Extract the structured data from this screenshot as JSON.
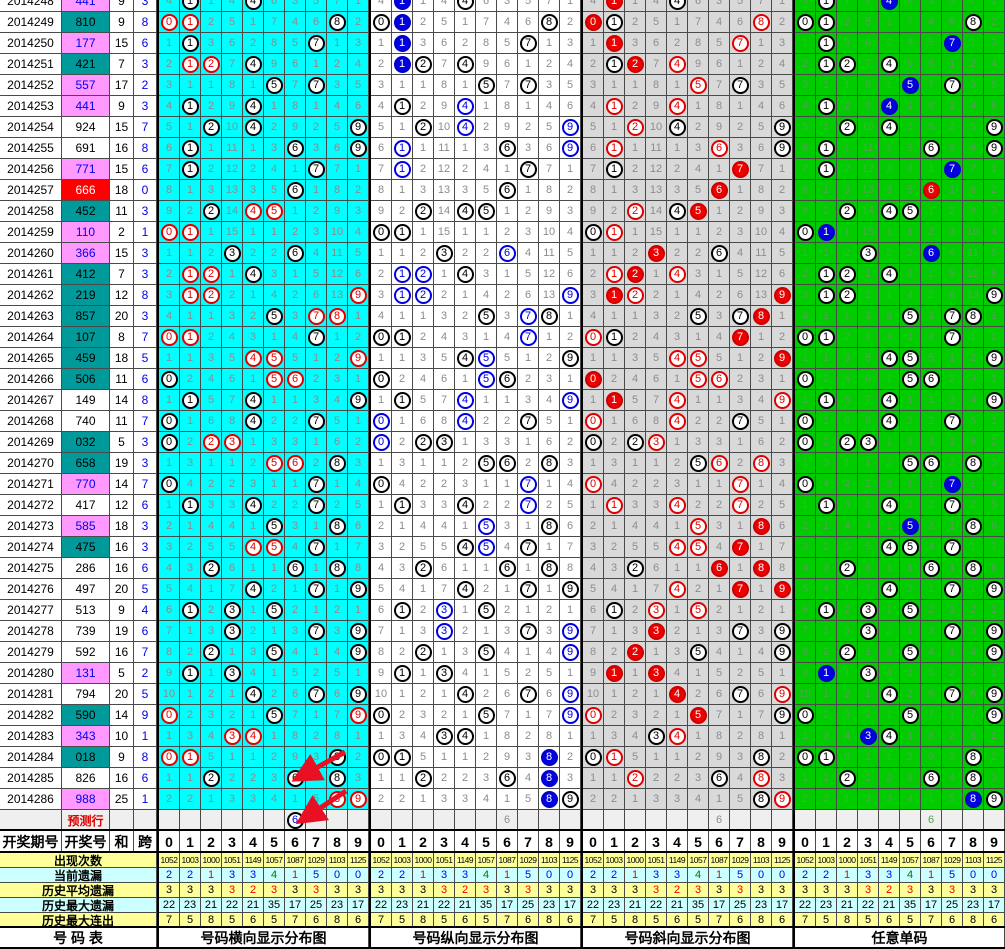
{
  "left_table": {
    "headers": {
      "period": "开奖期号",
      "number": "开奖号",
      "sum": "和",
      "span": "跨"
    },
    "footer_label": "号  码  表"
  },
  "panels": [
    {
      "key": "horizontal",
      "footer_label": "号码横向显示分布图",
      "bg": "#00FFFF"
    },
    {
      "key": "vertical",
      "footer_label": "号码纵向显示分布图",
      "bg": "#FFFFFF"
    },
    {
      "key": "diagonal",
      "footer_label": "号码斜向显示分布图",
      "bg": "#D9D9D9"
    },
    {
      "key": "single",
      "footer_label": "任意单码",
      "bg": "#00CC00"
    }
  ],
  "style_legend": {
    "k": "black-outline circle",
    "r": "red-outline circle",
    "R": "red-filled circle",
    "b": "blue-outline circle",
    "B": "blue-filled circle",
    "p": "black-outline blue-text circle"
  },
  "colors": {
    "b": "#0000EE",
    "r": "#EE0000",
    "g": "#007700",
    "k": "#000000",
    "arrow": "#E81123"
  },
  "chart_data": {
    "type": "table",
    "digit_columns": [
      "0",
      "1",
      "2",
      "3",
      "4",
      "5",
      "6",
      "7",
      "8",
      "9"
    ],
    "prediction_row_label": "预测行",
    "rows": [
      {
        "period": "2014248",
        "number": "441",
        "number_bg": "pink",
        "sum": "9",
        "span": "3",
        "clipped": true,
        "cells": [
          4,
          1,
          1,
          4,
          4,
          6,
          3,
          5,
          7,
          1
        ],
        "marks": [
          "1k,4k",
          "1B,4k",
          "1R,4k",
          "1k,4B"
        ]
      },
      {
        "period": "2014249",
        "number": "810",
        "number_bg": "teal",
        "sum": "9",
        "span": "8",
        "cells": [
          0,
          1,
          2,
          5,
          1,
          7,
          4,
          6,
          8,
          2
        ],
        "marks": [
          "0r,1r,8k",
          "0k,1B,8k",
          "0R,1k,8r",
          "0k,1k,8k"
        ]
      },
      {
        "period": "2014250",
        "number": "177",
        "number_bg": "pink",
        "sum": "15",
        "span": "6",
        "cells": [
          1,
          1,
          3,
          6,
          2,
          8,
          5,
          7,
          1,
          3
        ],
        "marks": [
          "1k,7k",
          "1B,7k",
          "1R,7r",
          "1k,7B"
        ]
      },
      {
        "period": "2014251",
        "number": "421",
        "number_bg": "teal",
        "sum": "7",
        "span": "3",
        "cells": [
          2,
          1,
          2,
          7,
          4,
          9,
          6,
          1,
          2,
          4
        ],
        "marks": [
          "1r,2r,4k",
          "1B,2k,4k",
          "1k,2R,4r",
          "1k,2k,4k"
        ]
      },
      {
        "period": "2014252",
        "number": "557",
        "number_bg": "pink",
        "sum": "17",
        "span": "2",
        "cells": [
          3,
          1,
          1,
          8,
          1,
          5,
          7,
          7,
          3,
          5
        ],
        "marks": [
          "5k,7k",
          "5k,7k",
          "5r,7k",
          "5B,7k"
        ]
      },
      {
        "period": "2014253",
        "number": "441",
        "number_bg": "pink",
        "sum": "9",
        "span": "3",
        "cells": [
          4,
          1,
          2,
          9,
          4,
          1,
          8,
          1,
          4,
          6
        ],
        "marks": [
          "1k,4k",
          "1k,4b",
          "1r,4r",
          "1k,4B"
        ]
      },
      {
        "period": "2014254",
        "number": "924",
        "number_bg": "white",
        "sum": "15",
        "span": "7",
        "cells": [
          5,
          1,
          2,
          10,
          4,
          2,
          9,
          2,
          5,
          9
        ],
        "marks": [
          "2k,4k,9k",
          "2k,4b,9b",
          "2r,4k,9k",
          "2k,4k,9k"
        ]
      },
      {
        "period": "2014255",
        "number": "691",
        "number_bg": "white",
        "sum": "16",
        "span": "8",
        "cells": [
          6,
          1,
          1,
          11,
          1,
          3,
          6,
          3,
          6,
          9
        ],
        "marks": [
          "1k,6k,9k",
          "1b,6k,9b",
          "1r,6r,9k",
          "1k,6k,9k"
        ]
      },
      {
        "period": "2014256",
        "number": "771",
        "number_bg": "pink",
        "sum": "15",
        "span": "6",
        "cells": [
          7,
          1,
          2,
          12,
          2,
          4,
          1,
          7,
          7,
          1
        ],
        "marks": [
          "1k,7k",
          "1b,7k",
          "1k,7R",
          "1k,7B"
        ]
      },
      {
        "period": "2014257",
        "number": "666",
        "number_bg": "red",
        "sum": "18",
        "span": "0",
        "cells": [
          8,
          1,
          3,
          13,
          3,
          5,
          6,
          1,
          8,
          2
        ],
        "marks": [
          "6k",
          "6k",
          "6R",
          "6R"
        ]
      },
      {
        "period": "2014258",
        "number": "452",
        "number_bg": "teal",
        "sum": "11",
        "span": "3",
        "cells": [
          9,
          2,
          2,
          14,
          4,
          5,
          1,
          2,
          9,
          3
        ],
        "marks": [
          "2k,4r,5r",
          "2k,4k,5k",
          "2r,4k,5R",
          "2k,4k,5k"
        ]
      },
      {
        "period": "2014259",
        "number": "110",
        "number_bg": "pink",
        "sum": "2",
        "span": "1",
        "cells": [
          0,
          1,
          1,
          15,
          1,
          1,
          2,
          3,
          10,
          4
        ],
        "marks": [
          "0r,1r",
          "0k,1k",
          "0k,1r",
          "0k,1B"
        ]
      },
      {
        "period": "2014260",
        "number": "366",
        "number_bg": "pink",
        "sum": "15",
        "span": "3",
        "cells": [
          1,
          1,
          2,
          3,
          2,
          2,
          6,
          4,
          11,
          5
        ],
        "marks": [
          "3k,6k",
          "3k,6b",
          "3R,6k",
          "3k,6B"
        ]
      },
      {
        "period": "2014261",
        "number": "412",
        "number_bg": "teal",
        "sum": "7",
        "span": "3",
        "cells": [
          2,
          1,
          2,
          1,
          4,
          3,
          1,
          5,
          12,
          6
        ],
        "marks": [
          "1r,2r,4k",
          "1b,2b,4k",
          "1r,2R,4r",
          "1k,2k,4k"
        ]
      },
      {
        "period": "2014262",
        "number": "219",
        "number_bg": "teal",
        "sum": "12",
        "span": "8",
        "cells": [
          3,
          1,
          2,
          2,
          1,
          4,
          2,
          6,
          13,
          9
        ],
        "marks": [
          "1r,2r,9r",
          "1b,2b,9b",
          "1R,2r,9R",
          "1k,2k,9k"
        ]
      },
      {
        "period": "2014263",
        "number": "857",
        "number_bg": "teal",
        "sum": "20",
        "span": "3",
        "cells": [
          4,
          1,
          1,
          3,
          2,
          5,
          3,
          7,
          8,
          1
        ],
        "marks": [
          "5k,7r,8r",
          "5k,7b,8k",
          "5k,7k,8R",
          "5k,7k,8k"
        ]
      },
      {
        "period": "2014264",
        "number": "107",
        "number_bg": "teal",
        "sum": "8",
        "span": "7",
        "cells": [
          0,
          1,
          2,
          4,
          3,
          1,
          4,
          7,
          1,
          2
        ],
        "marks": [
          "0r,1r,7k",
          "0k,1k,7b",
          "0r,1k,7R",
          "0k,1k,7k"
        ]
      },
      {
        "period": "2014265",
        "number": "459",
        "number_bg": "teal",
        "sum": "18",
        "span": "5",
        "cells": [
          1,
          1,
          3,
          5,
          4,
          5,
          5,
          1,
          2,
          9
        ],
        "marks": [
          "4r,5r,9r",
          "4k,5b,9k",
          "4r,5r,9R",
          "4k,5k,9k"
        ]
      },
      {
        "period": "2014266",
        "number": "506",
        "number_bg": "teal",
        "sum": "11",
        "span": "6",
        "cells": [
          0,
          2,
          4,
          6,
          1,
          5,
          6,
          2,
          3,
          1
        ],
        "marks": [
          "0k,5r,6r",
          "0k,5b,6k",
          "0R,5r,6r",
          "0k,5k,6k"
        ]
      },
      {
        "period": "2014267",
        "number": "149",
        "number_bg": "white",
        "sum": "14",
        "span": "8",
        "cells": [
          1,
          1,
          5,
          7,
          4,
          1,
          1,
          3,
          4,
          9
        ],
        "marks": [
          "1k,4k,9k",
          "1k,4b,9b",
          "1R,4r,9r",
          "1k,4k,9k"
        ]
      },
      {
        "period": "2014268",
        "number": "740",
        "number_bg": "white",
        "sum": "11",
        "span": "7",
        "cells": [
          0,
          1,
          6,
          8,
          4,
          2,
          2,
          7,
          5,
          1
        ],
        "marks": [
          "0k,4k,7k",
          "0b,4b,7k",
          "0r,4r,7k",
          "0k,4k,7k"
        ]
      },
      {
        "period": "2014269",
        "number": "032",
        "number_bg": "teal",
        "sum": "5",
        "span": "3",
        "cells": [
          0,
          2,
          2,
          3,
          1,
          3,
          3,
          1,
          6,
          2
        ],
        "marks": [
          "0k,2r,3r",
          "0b,2k,3k",
          "0k,2k,3r",
          "0k,2k,3k"
        ]
      },
      {
        "period": "2014270",
        "number": "658",
        "number_bg": "teal",
        "sum": "19",
        "span": "3",
        "cells": [
          1,
          3,
          1,
          1,
          2,
          5,
          6,
          2,
          8,
          3
        ],
        "marks": [
          "5r,6r,8k",
          "5k,6k,8k",
          "5k,6r,8r",
          "5k,6k,8k"
        ]
      },
      {
        "period": "2014271",
        "number": "770",
        "number_bg": "pink",
        "sum": "14",
        "span": "7",
        "cells": [
          0,
          4,
          2,
          2,
          3,
          1,
          1,
          7,
          1,
          4
        ],
        "marks": [
          "0k,7k",
          "0k,7b",
          "0r,7r",
          "0k,7B"
        ]
      },
      {
        "period": "2014272",
        "number": "417",
        "number_bg": "white",
        "sum": "12",
        "span": "6",
        "cells": [
          1,
          1,
          3,
          3,
          4,
          2,
          2,
          7,
          2,
          5
        ],
        "marks": [
          "1k,4k,7k",
          "1k,4k,7b",
          "1r,4r,7r",
          "1k,4k,7k"
        ]
      },
      {
        "period": "2014273",
        "number": "585",
        "number_bg": "pink",
        "sum": "18",
        "span": "3",
        "cells": [
          2,
          1,
          4,
          4,
          1,
          5,
          3,
          1,
          8,
          6
        ],
        "marks": [
          "5k,8k",
          "5b,8k",
          "5r,8R",
          "5B,8k"
        ]
      },
      {
        "period": "2014274",
        "number": "475",
        "number_bg": "teal",
        "sum": "16",
        "span": "3",
        "cells": [
          3,
          2,
          5,
          5,
          4,
          5,
          4,
          7,
          1,
          7
        ],
        "marks": [
          "4r,5r,7k",
          "4k,5b,7k",
          "4r,5r,7R",
          "4k,5k,7k"
        ]
      },
      {
        "period": "2014275",
        "number": "286",
        "number_bg": "white",
        "sum": "16",
        "span": "6",
        "cells": [
          4,
          3,
          2,
          6,
          1,
          1,
          6,
          1,
          8,
          8
        ],
        "marks": [
          "2k,6k,8k",
          "2k,6k,8k",
          "2k,6R,8R",
          "2k,6k,8k"
        ]
      },
      {
        "period": "2014276",
        "number": "497",
        "number_bg": "white",
        "sum": "20",
        "span": "5",
        "cells": [
          5,
          4,
          1,
          7,
          4,
          2,
          1,
          7,
          1,
          9
        ],
        "marks": [
          "4k,7k,9k",
          "4k,7k,9k",
          "4r,7R,9R",
          "4k,7k,9k"
        ]
      },
      {
        "period": "2014277",
        "number": "513",
        "number_bg": "white",
        "sum": "9",
        "span": "4",
        "cells": [
          6,
          1,
          2,
          3,
          1,
          5,
          2,
          1,
          2,
          1
        ],
        "marks": [
          "1k,3k,5k",
          "1k,3b,5k",
          "1k,3r,5r",
          "1k,3k,5k"
        ]
      },
      {
        "period": "2014278",
        "number": "739",
        "number_bg": "white",
        "sum": "19",
        "span": "6",
        "cells": [
          7,
          1,
          3,
          3,
          2,
          1,
          3,
          7,
          3,
          9
        ],
        "marks": [
          "3k,7k,9k",
          "3b,7k,9b",
          "3R,7k,9k",
          "3k,7k,9k"
        ]
      },
      {
        "period": "2014279",
        "number": "592",
        "number_bg": "white",
        "sum": "16",
        "span": "7",
        "cells": [
          8,
          2,
          2,
          1,
          3,
          5,
          4,
          1,
          4,
          9
        ],
        "marks": [
          "2k,5k,9k",
          "2k,5k,9b",
          "2R,5k,9k",
          "2k,5k,9k"
        ]
      },
      {
        "period": "2014280",
        "number": "131",
        "number_bg": "pink",
        "sum": "5",
        "span": "2",
        "cells": [
          9,
          1,
          1,
          3,
          4,
          1,
          5,
          2,
          5,
          1
        ],
        "marks": [
          "1k,3k",
          "1k,3k",
          "1R,3R",
          "1B,3k"
        ]
      },
      {
        "period": "2014281",
        "number": "794",
        "number_bg": "white",
        "sum": "20",
        "span": "5",
        "cells": [
          10,
          1,
          2,
          1,
          4,
          2,
          6,
          7,
          6,
          9
        ],
        "marks": [
          "4k,7k,9k",
          "4k,7k,9b",
          "4R,7k,9r",
          "4k,7k,9k"
        ]
      },
      {
        "period": "2014282",
        "number": "590",
        "number_bg": "teal",
        "sum": "14",
        "span": "9",
        "cells": [
          0,
          2,
          3,
          2,
          1,
          5,
          7,
          1,
          7,
          9
        ],
        "marks": [
          "0r,5k,9r",
          "0k,5k,9b",
          "0r,5R,9k",
          "0k,5k,9k"
        ]
      },
      {
        "period": "2014283",
        "number": "343",
        "number_bg": "pink",
        "sum": "10",
        "span": "1",
        "cells": [
          1,
          3,
          4,
          3,
          4,
          1,
          8,
          2,
          8,
          1
        ],
        "marks": [
          "3r,4r",
          "3k,4k",
          "3k,4r",
          "3B,4k"
        ]
      },
      {
        "period": "2014284",
        "number": "018",
        "number_bg": "teal",
        "sum": "9",
        "span": "8",
        "cells": [
          0,
          1,
          5,
          1,
          1,
          2,
          9,
          3,
          8,
          2
        ],
        "marks": [
          "0r,1r,8k",
          "0k,1k,8B",
          "0k,1r,8k",
          "0k,1k,8k"
        ]
      },
      {
        "period": "2014285",
        "number": "826",
        "number_bg": "white",
        "sum": "16",
        "span": "6",
        "cells": [
          1,
          1,
          2,
          2,
          2,
          3,
          6,
          4,
          8,
          3
        ],
        "marks": [
          "2k,6k,8k",
          "2k,6k,8B",
          "2r,6k,8r",
          "2k,6k,8k"
        ]
      },
      {
        "period": "2014286",
        "number": "988",
        "number_bg": "pink",
        "sum": "25",
        "span": "1",
        "cells": [
          2,
          2,
          1,
          3,
          3,
          4,
          1,
          5,
          8,
          9
        ],
        "marks": [
          "8r,9r",
          "8B,9k",
          "8k,9r",
          "8B,9k"
        ]
      },
      {
        "period": "",
        "number": "预测行",
        "number_bg": "pred",
        "sum": "",
        "span": "",
        "prediction": true,
        "cells": [
          "",
          "",
          "",
          "",
          "",
          "",
          "6",
          "",
          "",
          ""
        ],
        "marks": [
          "6p",
          "",
          "",
          ""
        ]
      }
    ],
    "stats": [
      {
        "label": "出现次数",
        "bg": "yellow",
        "small": true,
        "values": [
          "1052",
          "1003",
          "1000",
          "1051",
          "1149",
          "1057",
          "1087",
          "1029",
          "1103",
          "1125"
        ],
        "value_colors": null
      },
      {
        "label": "当前遗漏",
        "bg": "cyan",
        "values": [
          "2",
          "2",
          "1",
          "3",
          "3",
          "4",
          "1",
          "5",
          "0",
          "0"
        ],
        "value_colors": [
          "b",
          "b",
          "r",
          "b",
          "b",
          "g",
          "r",
          "b",
          "b",
          "b"
        ]
      },
      {
        "label": "历史平均遗漏",
        "bg": "yellow",
        "values": [
          "3",
          "3",
          "3",
          "3",
          "2",
          "3",
          "3",
          "3",
          "3",
          "3"
        ],
        "value_colors": [
          "k",
          "k",
          "k",
          "r",
          "r",
          "r",
          "k",
          "r",
          "k",
          "k"
        ]
      },
      {
        "label": "历史最大遗漏",
        "bg": "cyan",
        "values": [
          "22",
          "23",
          "21",
          "22",
          "21",
          "35",
          "17",
          "25",
          "23",
          "17"
        ],
        "value_colors": null
      },
      {
        "label": "历史最大连出",
        "bg": "yellow",
        "values": [
          "7",
          "5",
          "8",
          "5",
          "6",
          "5",
          "7",
          "6",
          "8",
          "6"
        ],
        "value_colors": null
      }
    ]
  },
  "arrows": [
    {
      "x1": 345,
      "y1": 752,
      "x2": 298,
      "y2": 778
    },
    {
      "x1": 346,
      "y1": 791,
      "x2": 302,
      "y2": 820
    }
  ]
}
